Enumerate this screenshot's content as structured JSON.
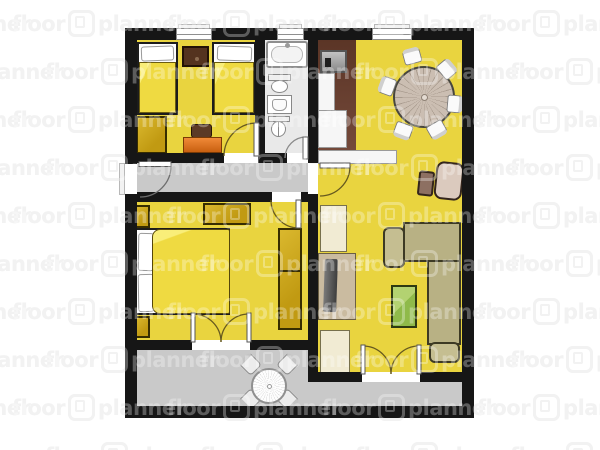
{
  "watermark": {
    "word1": "floor",
    "word2": "planner",
    "icon": "floorplanner-logo",
    "under_color": "#ececec",
    "over_color": "rgba(255,255,255,0.30)"
  },
  "palette": {
    "wall": "#161616",
    "room_yellow": "#e9d43f",
    "hall_gray": "#c9c9c9",
    "terrace_gray": "#c9c9c9",
    "bathroom_gray": "#e9e9e9",
    "kitchen_brown": "#6a4132",
    "furniture_dark_yellow": "#c9a21b",
    "sofa_olive": "#b8b184",
    "coffee_table_green": "#9fc35a",
    "armchair_beige": "#dbcabe",
    "desk_orange": "#e0701e",
    "wood_brown": "#583524"
  },
  "rooms": [
    {
      "id": "bedroom-1",
      "furniture": [
        "single-bed",
        "single-bed",
        "nightstand",
        "wardrobe",
        "desk",
        "desk-chair"
      ]
    },
    {
      "id": "bathroom",
      "furniture": [
        "bathtub",
        "toilet",
        "washbasin",
        "bidet"
      ]
    },
    {
      "id": "kitchen-dining",
      "furniture": [
        "stove",
        "kitchen-counter",
        "kitchen-counter",
        "sideboard",
        "round-dining-table",
        "dining-chair-x6"
      ]
    },
    {
      "id": "hallway",
      "furniture": []
    },
    {
      "id": "bedroom-2",
      "furniture": [
        "double-bed",
        "dresser",
        "wardrobe",
        "nightstand",
        "small-cabinet"
      ]
    },
    {
      "id": "living-room",
      "furniture": [
        "corner-sofa",
        "coffee-table",
        "armchair",
        "footstool",
        "tv",
        "tv-stand",
        "cabinet",
        "cabinet"
      ]
    },
    {
      "id": "terrace",
      "furniture": [
        "round-patio-table",
        "patio-chair-x4"
      ]
    }
  ],
  "doors": [
    "entrance-door",
    "bedroom-1-door",
    "bathroom-door",
    "bedroom-2-door",
    "hall-living-door",
    "bedroom-2-french-doors",
    "living-room-french-doors"
  ],
  "windows": [
    "bedroom-1-window",
    "bathroom-window",
    "dining-window"
  ]
}
